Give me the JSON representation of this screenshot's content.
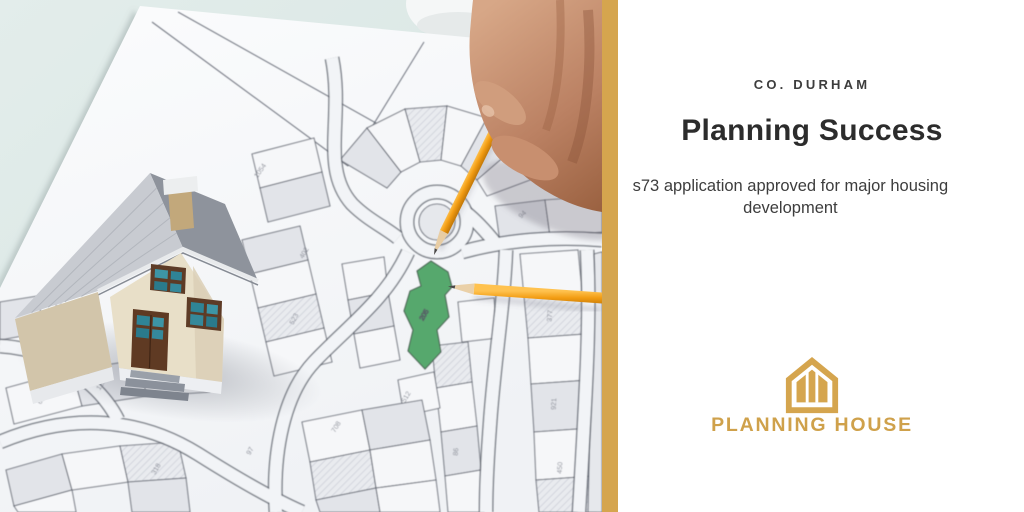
{
  "right_panel": {
    "eyebrow": "CO. DURHAM",
    "title": "Planning Success",
    "subtitle": "s73 application approved for major housing development",
    "brand_name": "PLANNING HOUSE",
    "logo_icon": "house-icon"
  },
  "colors": {
    "divider_gold": "#d5a54e",
    "brand_gold": "#cfa14b",
    "plot_green": "#57a86d",
    "background_mint": "#dde9e6",
    "heading_text": "#2c2c2c",
    "body_text": "#3d3d3d"
  },
  "photo": {
    "plot_label": "205",
    "map_labels": [
      "1054",
      "402",
      "523",
      "1432",
      "604",
      "1203",
      "318",
      "97",
      "708",
      "512",
      "86",
      "377",
      "921",
      "450",
      "94"
    ]
  }
}
